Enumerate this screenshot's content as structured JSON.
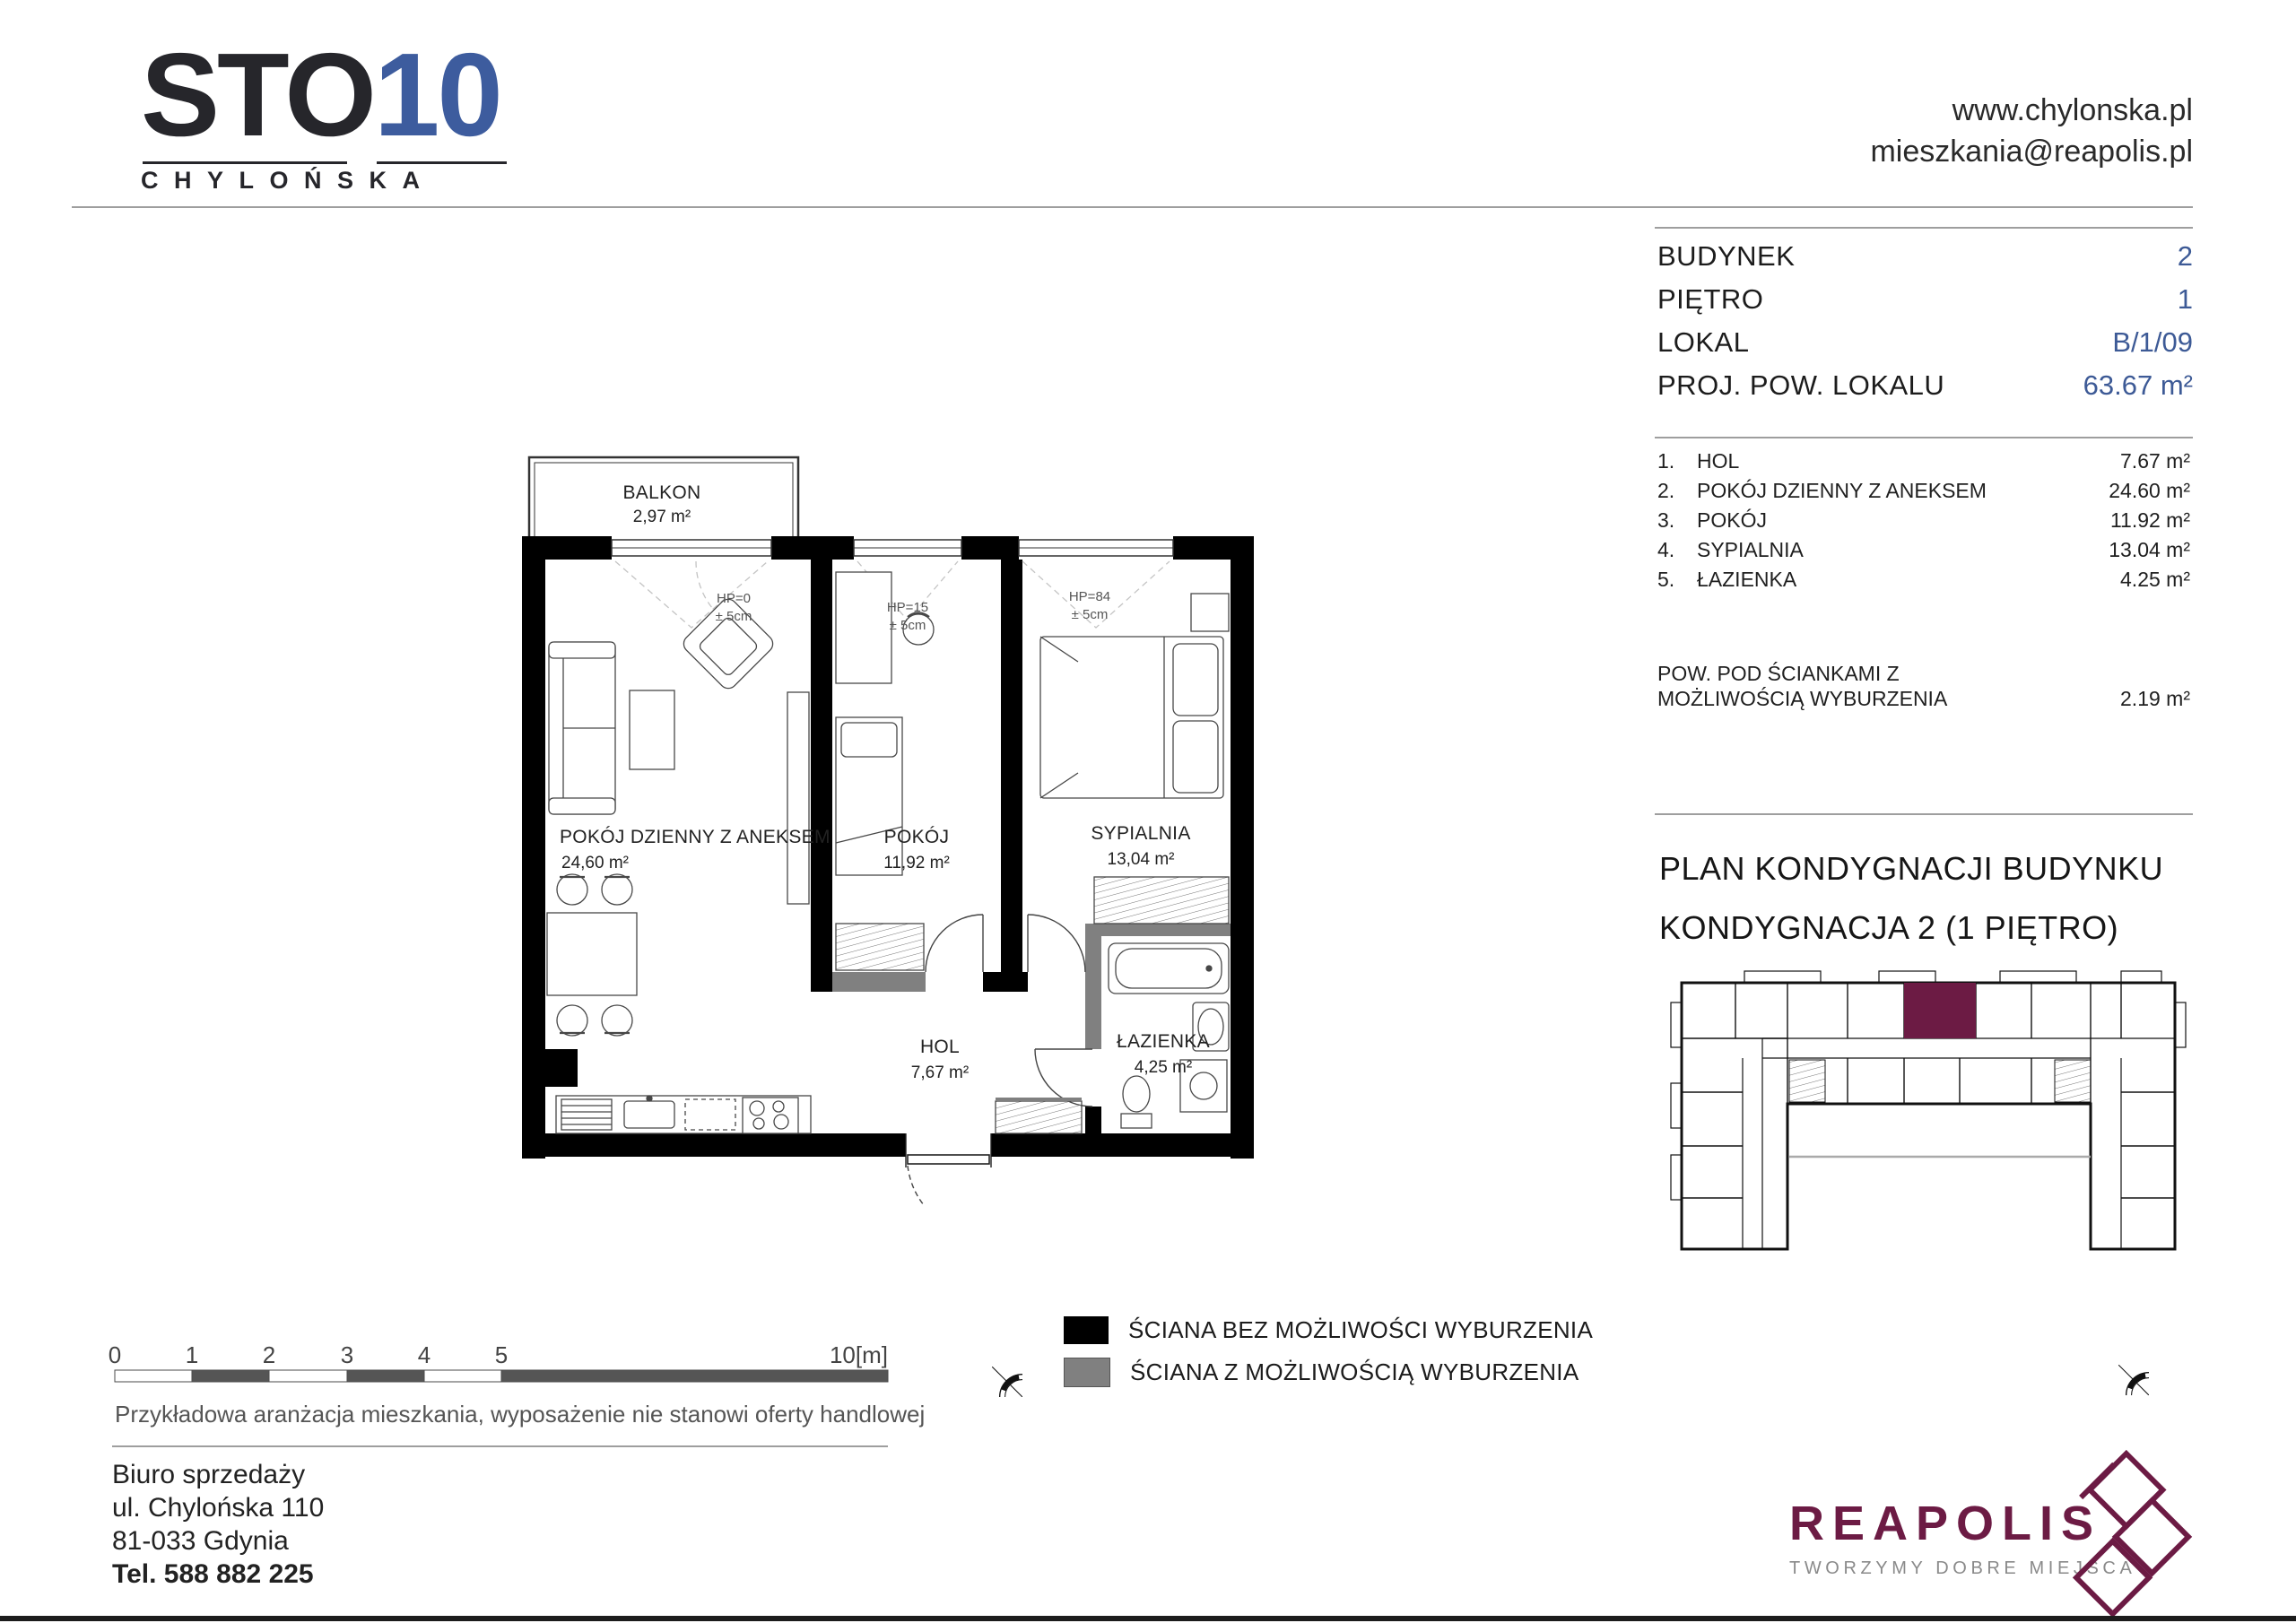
{
  "logo": {
    "sto": "STO",
    "ten": "10",
    "sub": "CHYLOŃSKA"
  },
  "header": {
    "website": "www.chylonska.pl",
    "email": "mieszkania@reapolis.pl"
  },
  "info": {
    "rows": [
      {
        "label": "BUDYNEK",
        "value": "2"
      },
      {
        "label": "PIĘTRO",
        "value": "1"
      },
      {
        "label": "LOKAL",
        "value": "B/1/09"
      },
      {
        "label": "PROJ. POW. LOKALU",
        "value": "63.67 m²"
      }
    ]
  },
  "rooms": [
    {
      "no": "1.",
      "name": "HOL",
      "area": "7.67 m²"
    },
    {
      "no": "2.",
      "name": "POKÓJ DZIENNY Z ANEKSEM",
      "area": "24.60 m²"
    },
    {
      "no": "3.",
      "name": "POKÓJ",
      "area": "11.92 m²"
    },
    {
      "no": "4.",
      "name": "SYPIALNIA",
      "area": "13.04 m²"
    },
    {
      "no": "5.",
      "name": "ŁAZIENKA",
      "area": "4.25 m²"
    }
  ],
  "walls_note": {
    "line1": "POW. POD ŚCIANKAMI Z",
    "line2": "MOŻLIWOŚCIĄ WYBURZENIA",
    "value": "2.19 m²"
  },
  "keyplan": {
    "title1": "PLAN KONDYGNACJI BUDYNKU",
    "title2": "KONDYGNACJA 2 (1 PIĘTRO)"
  },
  "plan": {
    "balkon": {
      "name": "BALKON",
      "area": "2,97 m²"
    },
    "rooms": [
      {
        "name": "POKÓJ DZIENNY Z ANEKSEM",
        "area": "24,60 m²"
      },
      {
        "name": "POKÓJ",
        "area": "11,92 m²"
      },
      {
        "name": "SYPIALNIA",
        "area": "13,04 m²"
      },
      {
        "name": "HOL",
        "area": "7,67 m²"
      },
      {
        "name": "ŁAZIENKA",
        "area": "4,25 m²"
      }
    ],
    "hp": [
      {
        "l1": "HP=0",
        "l2": "± 5cm"
      },
      {
        "l1": "HP=15",
        "l2": "± 5cm"
      },
      {
        "l1": "HP=84",
        "l2": "± 5cm"
      }
    ]
  },
  "scalebar": {
    "ticks": [
      "0",
      "1",
      "2",
      "3",
      "4",
      "5"
    ],
    "end": "10[m]"
  },
  "legend": {
    "items": [
      {
        "label": "ŚCIANA BEZ MOŻLIWOŚCI WYBURZENIA",
        "color": "#000000"
      },
      {
        "label": "ŚCIANA Z MOŻLIWOŚCIĄ WYBURZENIA",
        "color": "#808080"
      }
    ]
  },
  "caption": {
    "text": "Przykładowa aranżacja mieszkania, wyposażenie nie stanowi oferty handlowej"
  },
  "office": {
    "lines": [
      "Biuro sprzedaży",
      "ul. Chylońska 110",
      "81-033 Gdynia",
      "Tel. 588 882 225"
    ]
  },
  "reapolis": {
    "name": "REAPOLIS",
    "tagline": "TWORZYMY DOBRE MIEJSCA"
  },
  "compass": {
    "n": "N"
  },
  "colors": {
    "accent_blue": "#3d5a96",
    "brand_maroon": "#6c1b44",
    "wall_black": "#000000",
    "wall_gray": "#808080",
    "divider_gray": "#9e9e9e"
  }
}
